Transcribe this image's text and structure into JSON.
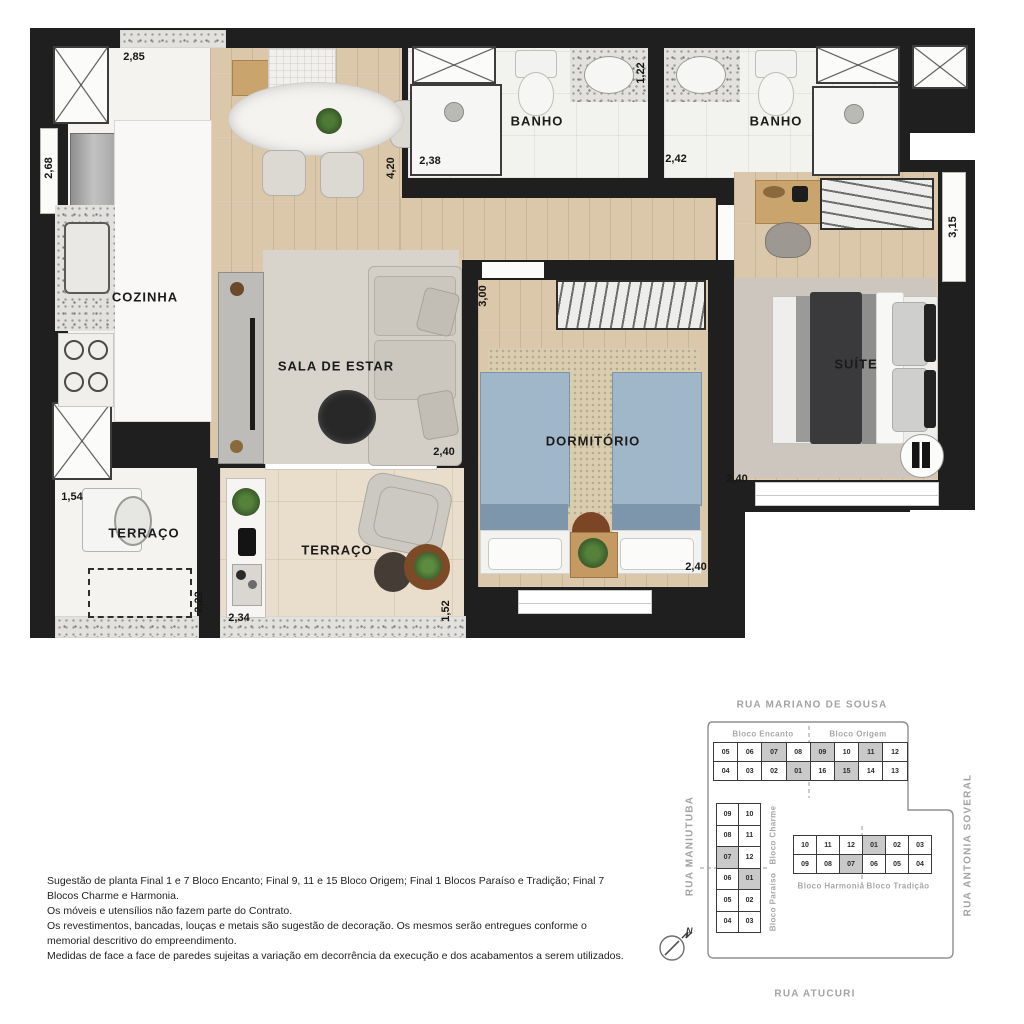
{
  "colors": {
    "wall": "#1f1f1f",
    "wood_floor": "#dbc7a9",
    "bed_blue": "#9fb7c9",
    "highlight_unit": "#c9c9c9",
    "street_text": "#a3a3a3"
  },
  "floor_plan": {
    "room_labels": [
      {
        "id": "cozinha",
        "text": "COZINHA",
        "x": 145,
        "y": 297
      },
      {
        "id": "sala-de-estar",
        "text": "SALA DE ESTAR",
        "x": 336,
        "y": 366
      },
      {
        "id": "banho-1",
        "text": "BANHO",
        "x": 537,
        "y": 121
      },
      {
        "id": "banho-2",
        "text": "BANHO",
        "x": 776,
        "y": 121
      },
      {
        "id": "dormitorio",
        "text": "DORMITÓRIO",
        "x": 593,
        "y": 441
      },
      {
        "id": "suite",
        "text": "SUÍTE",
        "x": 856,
        "y": 364
      },
      {
        "id": "terraco-servico",
        "text": "TERRAÇO",
        "x": 144,
        "y": 533
      },
      {
        "id": "terraco",
        "text": "TERRAÇO",
        "x": 337,
        "y": 550
      }
    ],
    "dimensions": [
      {
        "text": "2,85",
        "x": 134,
        "y": 57,
        "vertical": false
      },
      {
        "text": "2,68",
        "x": 49,
        "y": 168,
        "vertical": true
      },
      {
        "text": "4,20",
        "x": 391,
        "y": 168,
        "vertical": true
      },
      {
        "text": "2,38",
        "x": 430,
        "y": 161,
        "vertical": false
      },
      {
        "text": "1,22",
        "x": 641,
        "y": 73,
        "vertical": true
      },
      {
        "text": "2,42",
        "x": 676,
        "y": 159,
        "vertical": false
      },
      {
        "text": "3,15",
        "x": 953,
        "y": 227,
        "vertical": true
      },
      {
        "text": "3,00",
        "x": 483,
        "y": 296,
        "vertical": true
      },
      {
        "text": "2,40",
        "x": 444,
        "y": 452,
        "vertical": false
      },
      {
        "text": "2,40",
        "x": 737,
        "y": 479,
        "vertical": false
      },
      {
        "text": "2,40",
        "x": 696,
        "y": 567,
        "vertical": false
      },
      {
        "text": "1,54",
        "x": 72,
        "y": 497,
        "vertical": false
      },
      {
        "text": "2,22",
        "x": 199,
        "y": 602,
        "vertical": true
      },
      {
        "text": "2,34",
        "x": 239,
        "y": 618,
        "vertical": false
      },
      {
        "text": "1,52",
        "x": 446,
        "y": 611,
        "vertical": true
      }
    ]
  },
  "site_plan": {
    "streets": {
      "top": "RUA MARIANO DE SOUSA",
      "left": "RUA MANIUTUBA",
      "right": "RUA ANTONIA SOVERAL",
      "bottom": "RUA ATUCURI"
    },
    "compass_label": "N",
    "blocks": {
      "north": {
        "labels": [
          "Bloco Encanto",
          "Bloco Origem"
        ],
        "rows": [
          [
            {
              "n": "05"
            },
            {
              "n": "06"
            },
            {
              "n": "07",
              "hl": true
            },
            {
              "n": "08"
            },
            {
              "n": "09",
              "hl": true
            },
            {
              "n": "10"
            },
            {
              "n": "11",
              "hl": true
            },
            {
              "n": "12"
            }
          ],
          [
            {
              "n": "04"
            },
            {
              "n": "03"
            },
            {
              "n": "02"
            },
            {
              "n": "01",
              "hl": true
            },
            {
              "n": "16"
            },
            {
              "n": "15",
              "hl": true
            },
            {
              "n": "14"
            },
            {
              "n": "13"
            }
          ]
        ]
      },
      "west": {
        "labels": [
          "Bloco Charme",
          "Bloco Paraíso"
        ],
        "rows": [
          [
            {
              "n": "09"
            },
            {
              "n": "10"
            }
          ],
          [
            {
              "n": "08"
            },
            {
              "n": "11"
            }
          ],
          [
            {
              "n": "07",
              "hl": true
            },
            {
              "n": "12"
            }
          ],
          [
            {
              "n": "06"
            },
            {
              "n": "01",
              "hl": true
            }
          ],
          [
            {
              "n": "05"
            },
            {
              "n": "02"
            }
          ],
          [
            {
              "n": "04"
            },
            {
              "n": "03"
            }
          ]
        ]
      },
      "south": {
        "labels": [
          "Bloco Harmonia",
          "Bloco Tradição"
        ],
        "rows": [
          [
            {
              "n": "10"
            },
            {
              "n": "11"
            },
            {
              "n": "12"
            },
            {
              "n": "01",
              "hl": true
            },
            {
              "n": "02"
            },
            {
              "n": "03"
            }
          ],
          [
            {
              "n": "09"
            },
            {
              "n": "08"
            },
            {
              "n": "07",
              "hl": true
            },
            {
              "n": "06"
            },
            {
              "n": "05"
            },
            {
              "n": "04"
            }
          ]
        ]
      }
    }
  },
  "disclaimer": {
    "lines": [
      "Sugestão de planta Final 1 e 7 Bloco Encanto; Final 9, 11 e 15 Bloco Origem; Final 1 Blocos Paraíso e Tradição; Final 7",
      "Blocos Charme e Harmonia.",
      "Os móveis e utensílios não fazem parte do Contrato.",
      "Os revestimentos, bancadas, louças e metais são sugestão de decoração. Os mesmos serão entregues conforme o",
      "memorial descritivo do empreendimento.",
      "Medidas de face a face de paredes sujeitas a variação em decorrência da execução e dos acabamentos a serem utilizados."
    ]
  }
}
